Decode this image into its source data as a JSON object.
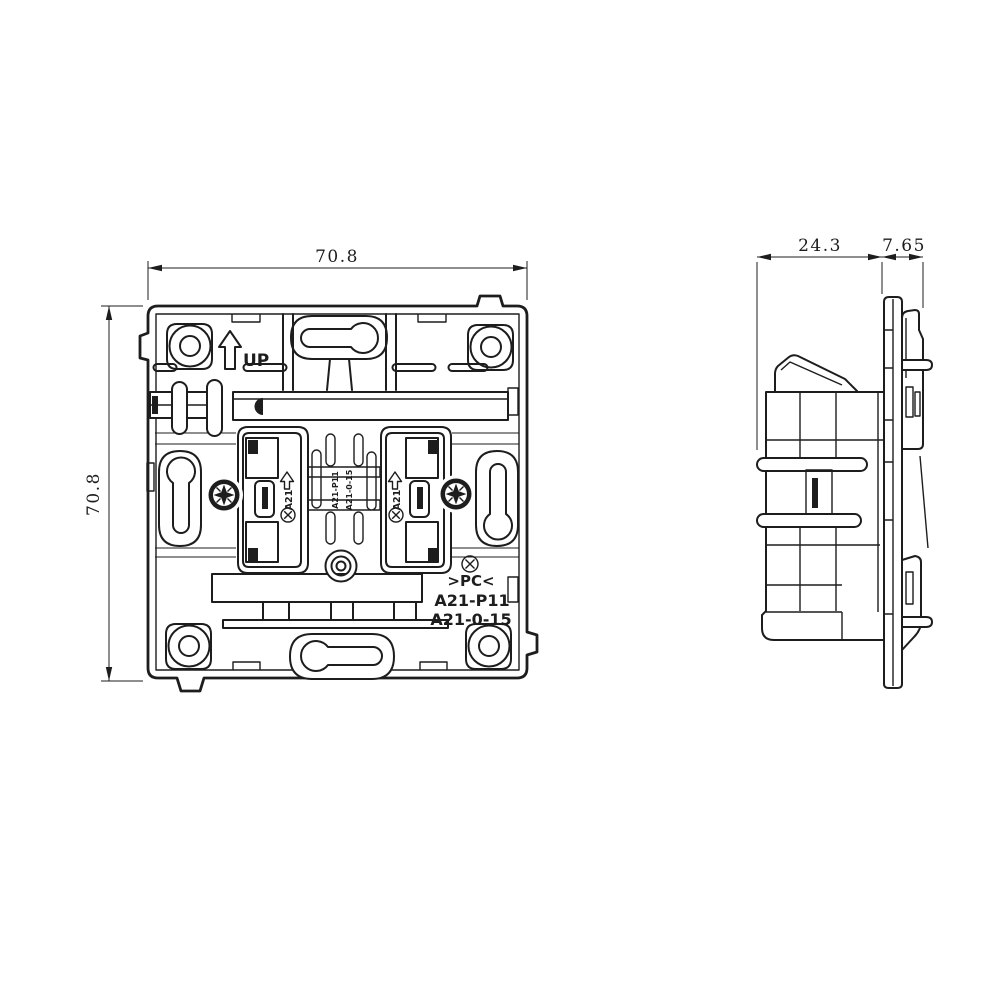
{
  "drawing": {
    "front": {
      "dim_width": "70.8",
      "dim_height": "70.8",
      "up_label": "UP",
      "terminal_left": "A21",
      "terminal_right": "A21",
      "mold_text_1": "A21-P11",
      "mold_text_2": "A21-0-15",
      "material": ">PC<",
      "model_1": "A21-P11",
      "model_2": "A21-0-15"
    },
    "side": {
      "dim_body": "24.3",
      "dim_flange": "7.65"
    },
    "icons": {
      "up_arrow": "hollow-up-arrow",
      "circled_x": "circle-with-x-mark",
      "screw": "pozidriv-screw-head"
    },
    "colors": {
      "line": "#1d1d1d",
      "background": "#ffffff"
    }
  }
}
